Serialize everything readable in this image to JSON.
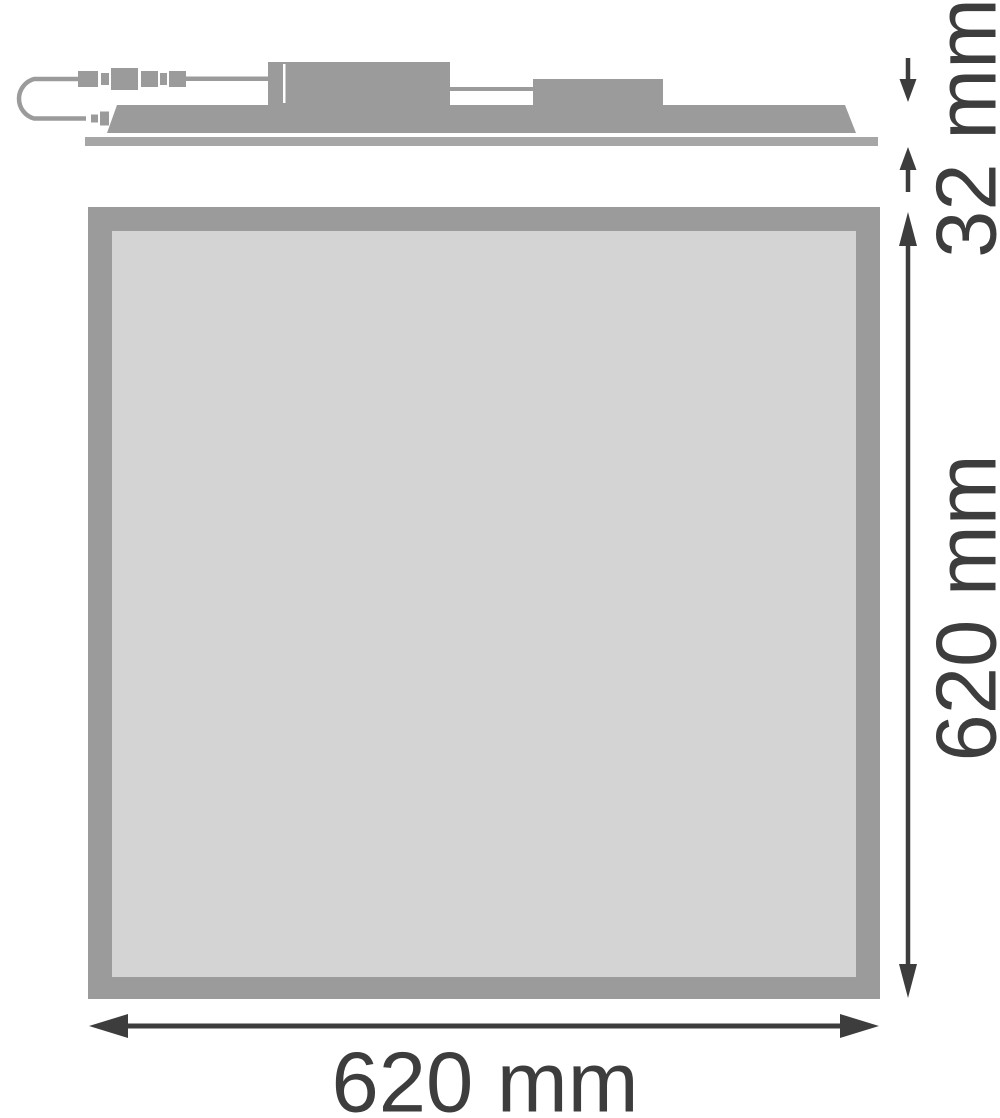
{
  "drawing": {
    "dimensions": {
      "fixture_height": {
        "label": "32 mm",
        "value": 32,
        "unit": "mm"
      },
      "panel_height": {
        "label": "620 mm",
        "value": 620,
        "unit": "mm"
      },
      "panel_width": {
        "label": "620 mm",
        "value": 620,
        "unit": "mm"
      }
    },
    "colors": {
      "part_gray": "#9b9b9b",
      "baseplate_gray": "#a6a6a6",
      "surface_gray": "#d4d4d4",
      "dimension_dark": "#3d3d3d",
      "background": "#ffffff"
    }
  }
}
